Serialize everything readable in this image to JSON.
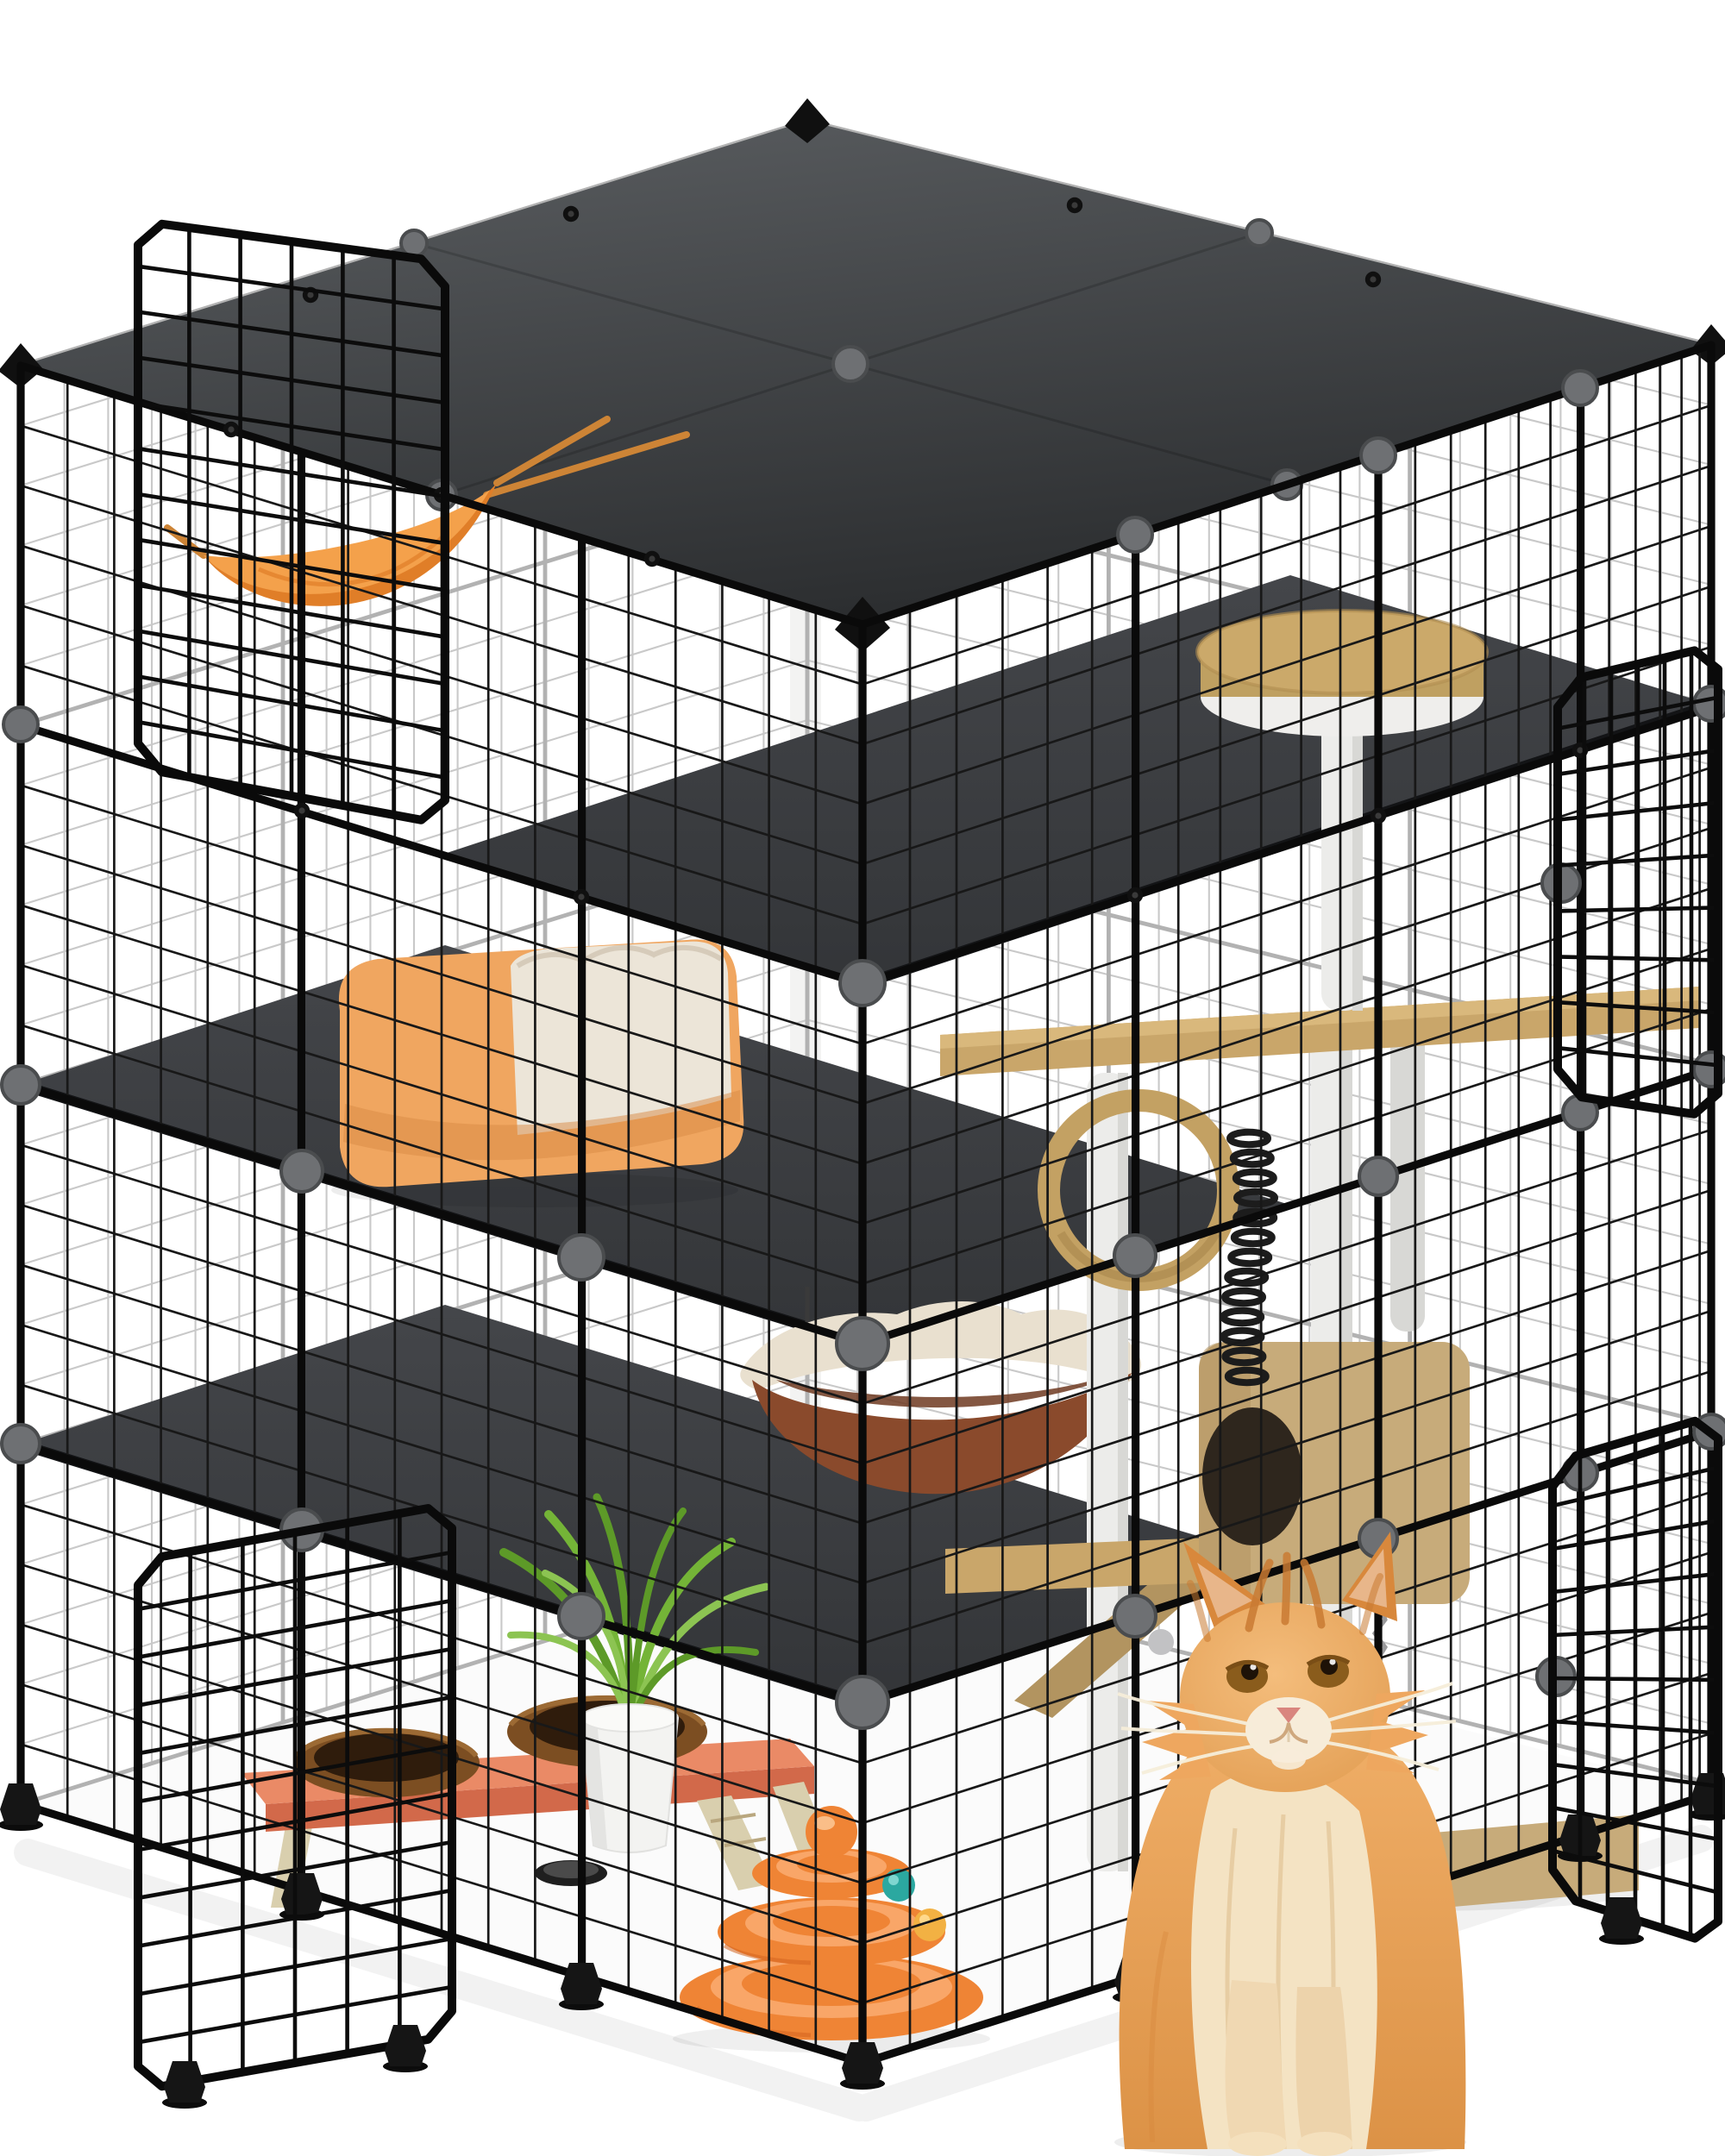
{
  "page": {
    "background": "#ffffff"
  },
  "scene": {
    "type": "product-photo",
    "subject": "Large DIY modular metal-wire cat cage enclosure (catio) shown open with accessories and a long-haired ginger cat sitting in front",
    "enclosure": {
      "structure": "grid wire panels joined by round connectors, dark roof and shelf panels, black corner feet",
      "open_doors": [
        "top-left hatch",
        "bottom-left door",
        "upper-right door",
        "lower-right door"
      ]
    },
    "accessories": [
      "orange hanging cat hammock",
      "orange pet bed with cream cushion",
      "brown hanging bowl bed with cream rim",
      "wooden cat tree with round top perch, plank, wooden ring, cube condo, ramp and base mat",
      "black spring toy",
      "terracotta raised feeder with two wooden bowls",
      "white potted green spider plant",
      "orange three-tier ball track toy with teal and yellow balls"
    ],
    "animal": {
      "species": "cat",
      "look": "long-haired ginger tabby with cream chest",
      "pose": "sitting upright, looking up",
      "position": "front right, outside the enclosure"
    }
  },
  "colors": {
    "pageBg": "#ffffff",
    "wireFront": "#181818",
    "wireBar": "#0a0a0a",
    "wireBack": "#c9c9c9",
    "wireBackBar": "#b2b2b2",
    "roofLight": "#55585b",
    "roofDark": "#2c2e30",
    "shelfDark": "#3c3e41",
    "shelfEdge": "#131416",
    "connGray": "#6e7073",
    "connGrayDark": "#4a4c4e",
    "hwBlack": "#101010",
    "hammock": "#f4a14b",
    "hammockDeep": "#e07e28",
    "strap": "#cd8436",
    "bedOrange": "#f0a660",
    "bedShadow": "#d88a43",
    "cushion": "#ece5d8",
    "cushionLine": "#d6cbba",
    "perchTop": "#cba96a",
    "perchSide": "#bfa061",
    "perchBase": "#efeeec",
    "post": "#ececea",
    "postShade": "#d8d8d5",
    "plank": "#c9a66a",
    "ring": "#c3a163",
    "ringShade": "#a8874c",
    "cube": "#c7ab7a",
    "cubeShade": "#b29460",
    "hole": "#2e261d",
    "hangRim": "#e9e0cf",
    "hangBowl": "#8a4a2c",
    "hangBowlDark": "#6f3a21",
    "standTop": "#ea8a66",
    "standSide": "#d2694a",
    "legWood": "#d9cfae",
    "bowl": "#7c4e22",
    "bowlIn": "#2f1c0c",
    "pot": "#f3f3f1",
    "leaf1": "#5d9a28",
    "leaf2": "#74b437",
    "leaf3": "#8cc452",
    "toy": "#ef8435",
    "toyLight": "#f9a668",
    "toyDark": "#d4641f",
    "teal": "#2ba8a0",
    "ballYellow": "#f2b143",
    "catA": "#eea75f",
    "catB": "#d8883c",
    "catCream": "#f4e3c3",
    "catStripe": "#c97a32",
    "catEar": "#e8b68a",
    "eye": "#8a5c1c",
    "pupil": "#1e1207",
    "nose": "#d9857e",
    "whisker": "#f6eeda"
  }
}
